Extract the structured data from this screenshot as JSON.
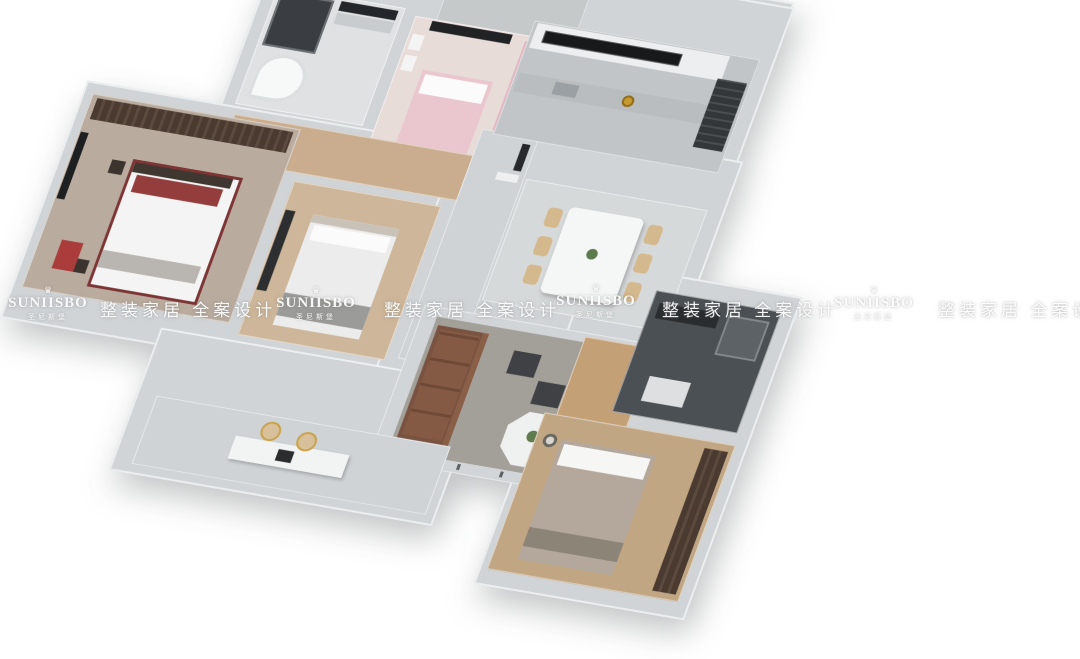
{
  "canvas": {
    "width": 1080,
    "height": 608,
    "background": "#ffffff"
  },
  "watermark": {
    "crown_icon": "♛",
    "brand_latin": "SUNIISBO",
    "brand_cn": "圣尼斯堡",
    "tagline": "整装家居 全案设计"
  },
  "palette": {
    "wall": "#d0d4d6",
    "marble_floor": "#d4d7d9",
    "wood_floor": "#c5a887",
    "dark_tile": "#4b5054",
    "pink_bed": "#eac7cf",
    "sofa_brown": "#7a5340",
    "chair_beige": "#d5b98e",
    "accent_red": "#a03636",
    "accent_gold": "#c79a2e"
  }
}
